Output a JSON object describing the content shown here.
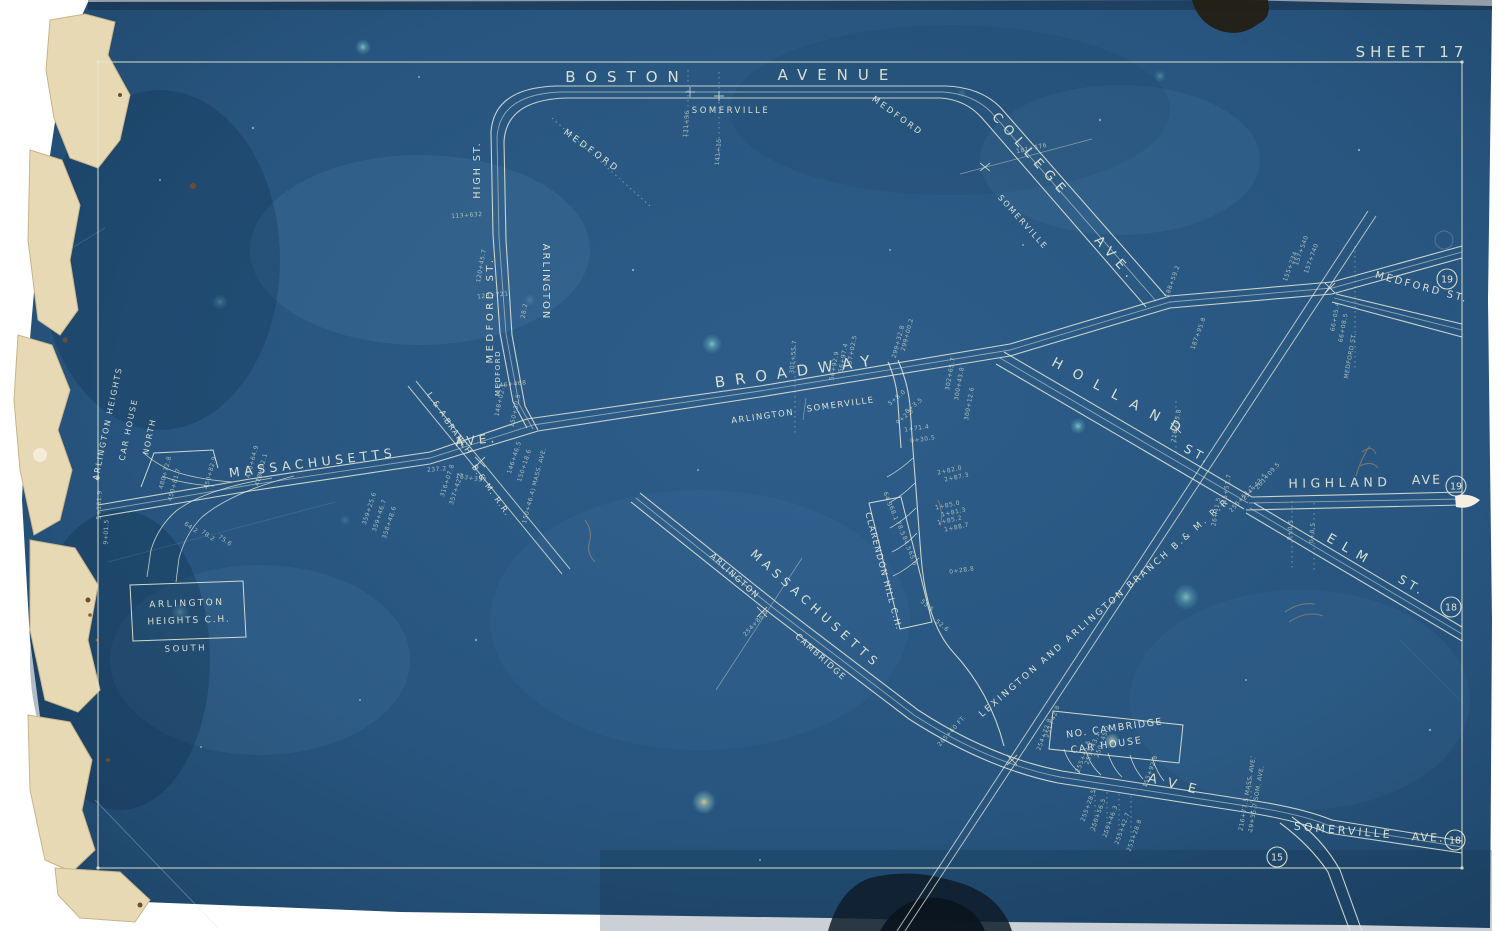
{
  "map": {
    "sheet_label": "SHEET 17",
    "colors": {
      "blueprint_blue": "#24527e",
      "blueprint_edge": "#1c4062",
      "line_pale": "#e6e8d6",
      "torn_paper_cream": "#e7d9b4",
      "pencil_sepia": "#b98e5e",
      "stain_dark": "#241d12"
    },
    "street_labels": [
      {
        "t": "BOSTON",
        "x": 627,
        "y": 82,
        "r": 0,
        "s": 15,
        "sp": 10
      },
      {
        "t": "AVENUE",
        "x": 838,
        "y": 80,
        "r": 0,
        "s": 15,
        "sp": 10
      },
      {
        "t": "SOMERVILLE",
        "x": 731,
        "y": 113,
        "r": 0,
        "s": 8.5,
        "sp": 2.5
      },
      {
        "t": "MEDFORD",
        "x": 896,
        "y": 118,
        "r": 36,
        "s": 8.5,
        "sp": 2.5
      },
      {
        "t": "MEDFORD",
        "x": 590,
        "y": 153,
        "r": 36,
        "s": 9,
        "sp": 3
      },
      {
        "t": "HIGH ST.",
        "x": 480,
        "y": 170,
        "r": -90,
        "s": 9.5,
        "sp": 2
      },
      {
        "t": "MEDFORD ST.",
        "x": 493,
        "y": 310,
        "r": -90,
        "s": 10,
        "sp": 3.5
      },
      {
        "t": "ARLINGTON",
        "x": 543,
        "y": 282,
        "r": 90,
        "s": 10,
        "sp": 2
      },
      {
        "t": "MEDFORD",
        "x": 500,
        "y": 373,
        "r": -90,
        "s": 7,
        "sp": 1.5
      },
      {
        "t": "COLLEGE",
        "x": 1028,
        "y": 158,
        "r": 48,
        "s": 13,
        "sp": 7
      },
      {
        "t": "AVE.",
        "x": 1113,
        "y": 262,
        "r": 48,
        "s": 13,
        "sp": 7
      },
      {
        "t": "SOMERVILLE",
        "x": 1021,
        "y": 224,
        "r": 48,
        "s": 8,
        "sp": 2
      },
      {
        "t": "BROADWAY",
        "x": 798,
        "y": 376,
        "r": -8,
        "s": 15,
        "sp": 10
      },
      {
        "t": "ARLINGTON",
        "x": 763,
        "y": 419,
        "r": -8,
        "s": 8.5,
        "sp": 1.5
      },
      {
        "t": "SOMERVILLE",
        "x": 841,
        "y": 407,
        "r": -8,
        "s": 8.5,
        "sp": 1.5
      },
      {
        "t": "MASSACHUSETTS",
        "x": 313,
        "y": 467,
        "r": -7,
        "s": 12.5,
        "sp": 4.5
      },
      {
        "t": "AVE.",
        "x": 477,
        "y": 444,
        "r": -6,
        "s": 12,
        "sp": 4
      },
      {
        "t": "L.& A.",
        "x": 436,
        "y": 408,
        "r": 55,
        "s": 8,
        "sp": 1.5
      },
      {
        "t": "BRANCH",
        "x": 456,
        "y": 438,
        "r": 55,
        "s": 8,
        "sp": 1.5
      },
      {
        "t": "B.& M. R.R.",
        "x": 489,
        "y": 492,
        "r": 55,
        "s": 8,
        "sp": 1.5
      },
      {
        "t": "HOLLAND",
        "x": 1120,
        "y": 402,
        "r": 28,
        "s": 13.5,
        "sp": 13
      },
      {
        "t": "ST.",
        "x": 1196,
        "y": 458,
        "r": 28,
        "s": 12,
        "sp": 4
      },
      {
        "t": "HIGHLAND",
        "x": 1340,
        "y": 487,
        "r": -1,
        "s": 12.5,
        "sp": 4.5
      },
      {
        "t": "AVE",
        "x": 1427,
        "y": 484,
        "r": -1,
        "s": 12.5,
        "sp": 2
      },
      {
        "t": "ELM",
        "x": 1349,
        "y": 554,
        "r": 30,
        "s": 13,
        "sp": 9
      },
      {
        "t": "ST.",
        "x": 1410,
        "y": 589,
        "r": 30,
        "s": 12,
        "sp": 4
      },
      {
        "t": "MEDFORD ST.",
        "x": 1421,
        "y": 290,
        "r": 15,
        "s": 10,
        "sp": 2.5
      },
      {
        "t": "LEXINGTON AND ARLINGTON BRANCH B.& M. R.R.",
        "x": 1108,
        "y": 608,
        "r": -41,
        "s": 9,
        "sp": 2.6
      },
      {
        "t": "MASSACHUSETTS",
        "x": 813,
        "y": 612,
        "r": 42,
        "s": 12,
        "sp": 5
      },
      {
        "t": "ARLINGTON",
        "x": 733,
        "y": 578,
        "r": 42,
        "s": 8.5,
        "sp": 1.5
      },
      {
        "t": "CAMBRIDGE",
        "x": 819,
        "y": 659,
        "r": 42,
        "s": 8.5,
        "sp": 1.5
      },
      {
        "t": "ARLINGTON HEIGHTS",
        "x": 110,
        "y": 424,
        "r": -78,
        "s": 8,
        "sp": 1.8
      },
      {
        "t": "CAR HOUSE",
        "x": 131,
        "y": 430,
        "r": -78,
        "s": 8,
        "sp": 1.8
      },
      {
        "t": "NORTH",
        "x": 152,
        "y": 437,
        "r": -78,
        "s": 8,
        "sp": 1.8
      },
      {
        "t": "ARLINGTON",
        "x": 187,
        "y": 606,
        "r": -2,
        "s": 9,
        "sp": 2.5
      },
      {
        "t": "HEIGHTS C.H.",
        "x": 189,
        "y": 623,
        "r": -2,
        "s": 9,
        "sp": 1.8
      },
      {
        "t": "SOUTH",
        "x": 186,
        "y": 651,
        "r": -2,
        "s": 8.5,
        "sp": 2.5
      },
      {
        "t": "CLARENDON HILL C.H.",
        "x": 881,
        "y": 572,
        "r": 75,
        "s": 8.5,
        "sp": 1.4
      },
      {
        "t": "NO. CAMBRIDGE",
        "x": 1115,
        "y": 731,
        "r": -8,
        "s": 9.5,
        "sp": 1.5
      },
      {
        "t": "CAR HOUSE",
        "x": 1107,
        "y": 748,
        "r": -8,
        "s": 9.5,
        "sp": 1.8
      },
      {
        "t": "AVE",
        "x": 1177,
        "y": 789,
        "r": 14,
        "s": 13,
        "sp": 12
      },
      {
        "t": "SOMERVILLE",
        "x": 1343,
        "y": 834,
        "r": 5,
        "s": 11,
        "sp": 3
      },
      {
        "t": "AVE.",
        "x": 1428,
        "y": 841,
        "r": 3,
        "s": 11,
        "sp": 2
      }
    ],
    "station_marks": [
      {
        "t": "5+131.9",
        "x": 101,
        "y": 505,
        "r": -88
      },
      {
        "t": "9+01.5",
        "x": 108,
        "y": 532,
        "r": -88
      },
      {
        "t": "480+72.8",
        "x": 167,
        "y": 473,
        "r": -75
      },
      {
        "t": "450+81.7",
        "x": 176,
        "y": 485,
        "r": -75
      },
      {
        "t": "450+82.9",
        "x": 212,
        "y": 473,
        "r": -75
      },
      {
        "t": "410+64.9",
        "x": 254,
        "y": 462,
        "r": -75
      },
      {
        "t": "418+92.1",
        "x": 263,
        "y": 470,
        "r": -75
      },
      {
        "t": "64.2",
        "x": 190,
        "y": 529,
        "r": 35
      },
      {
        "t": "78.2",
        "x": 207,
        "y": 537,
        "r": 35
      },
      {
        "t": "75.6",
        "x": 224,
        "y": 542,
        "r": 35
      },
      {
        "t": "359+25.6",
        "x": 371,
        "y": 509,
        "r": -72
      },
      {
        "t": "359+46.7",
        "x": 381,
        "y": 516,
        "r": -72
      },
      {
        "t": "358+48.6",
        "x": 391,
        "y": 523,
        "r": -72
      },
      {
        "t": "237.2",
        "x": 437,
        "y": 471,
        "r": -5
      },
      {
        "t": "163+337",
        "x": 471,
        "y": 480,
        "r": 8
      },
      {
        "t": "316+07.8",
        "x": 449,
        "y": 481,
        "r": -72
      },
      {
        "t": "357+42.5",
        "x": 458,
        "y": 489,
        "r": -72
      },
      {
        "t": "146+46.5",
        "x": 516,
        "y": 458,
        "r": -72
      },
      {
        "t": "150+18.6",
        "x": 526,
        "y": 466,
        "r": -72
      },
      {
        "t": "150+46.4) MASS. AVE.",
        "x": 536,
        "y": 486,
        "r": -75
      },
      {
        "t": "113+632",
        "x": 467,
        "y": 217,
        "r": -4
      },
      {
        "t": "120+45.7",
        "x": 483,
        "y": 266,
        "r": -80
      },
      {
        "t": "123+721",
        "x": 493,
        "y": 297,
        "r": -6
      },
      {
        "t": "28.2",
        "x": 526,
        "y": 311,
        "r": -80
      },
      {
        "t": "146+468",
        "x": 511,
        "y": 386,
        "r": -6
      },
      {
        "t": "148+02.1",
        "x": 502,
        "y": 400,
        "r": -78
      },
      {
        "t": "150+30.5",
        "x": 517,
        "y": 411,
        "r": -78
      },
      {
        "t": "131+96",
        "x": 688,
        "y": 124,
        "r": -85
      },
      {
        "t": "141+15",
        "x": 720,
        "y": 152,
        "r": -85
      },
      {
        "t": "181+176",
        "x": 1032,
        "y": 150,
        "r": -12
      },
      {
        "t": "301+55.7",
        "x": 795,
        "y": 357,
        "r": -85
      },
      {
        "t": "56+92.9",
        "x": 836,
        "y": 366,
        "r": -80
      },
      {
        "t": "56+97.4",
        "x": 845,
        "y": 358,
        "r": -80
      },
      {
        "t": "57+02.5",
        "x": 854,
        "y": 350,
        "r": -80
      },
      {
        "t": "299+32.8",
        "x": 900,
        "y": 342,
        "r": -75
      },
      {
        "t": "299+00.2",
        "x": 909,
        "y": 335,
        "r": -75
      },
      {
        "t": "302+65.7",
        "x": 952,
        "y": 374,
        "r": -80
      },
      {
        "t": "300+43.8",
        "x": 961,
        "y": 384,
        "r": -80
      },
      {
        "t": "300+12.6",
        "x": 971,
        "y": 404,
        "r": -80
      },
      {
        "t": "5+8.0",
        "x": 898,
        "y": 399,
        "r": -40
      },
      {
        "t": "8+3.5",
        "x": 915,
        "y": 407,
        "r": -40
      },
      {
        "t": "9+2.5",
        "x": 906,
        "y": 418,
        "r": -40
      },
      {
        "t": "1+71.4",
        "x": 917,
        "y": 430,
        "r": -8
      },
      {
        "t": "0+30.5",
        "x": 923,
        "y": 441,
        "r": -8
      },
      {
        "t": "2+82.0",
        "x": 950,
        "y": 472,
        "r": -12
      },
      {
        "t": "2+87.3",
        "x": 957,
        "y": 479,
        "r": -12
      },
      {
        "t": "1+85.0",
        "x": 948,
        "y": 507,
        "r": -12
      },
      {
        "t": "1+81.3",
        "x": 954,
        "y": 514,
        "r": -12
      },
      {
        "t": "1+85.2",
        "x": 950,
        "y": 522,
        "r": -12
      },
      {
        "t": "1+88.7",
        "x": 957,
        "y": 529,
        "r": -12
      },
      {
        "t": "0+28.8",
        "x": 962,
        "y": 572,
        "r": -8
      },
      {
        "t": "64.3",
        "x": 886,
        "y": 500,
        "r": 70
      },
      {
        "t": "68.1",
        "x": 892,
        "y": 514,
        "r": 70
      },
      {
        "t": "78.5",
        "x": 899,
        "y": 529,
        "r": 70
      },
      {
        "t": "84.5",
        "x": 905,
        "y": 544,
        "r": 70
      },
      {
        "t": "65.6",
        "x": 911,
        "y": 559,
        "r": 70
      },
      {
        "t": "55.5",
        "x": 926,
        "y": 607,
        "r": 40
      },
      {
        "t": "52.6",
        "x": 941,
        "y": 627,
        "r": 40
      },
      {
        "t": "216+05.8",
        "x": 1178,
        "y": 426,
        "r": -80
      },
      {
        "t": "215+51.7",
        "x": 1228,
        "y": 491,
        "r": -80
      },
      {
        "t": "26+41.5",
        "x": 1218,
        "y": 512,
        "r": -80
      },
      {
        "t": "255+51.7",
        "x": 1243,
        "y": 500,
        "r": -48
      },
      {
        "t": "254+43.5",
        "x": 1256,
        "y": 488,
        "r": -48
      },
      {
        "t": "261+09.5",
        "x": 1269,
        "y": 477,
        "r": -48
      },
      {
        "t": "188+59.2",
        "x": 1174,
        "y": 282,
        "r": -70
      },
      {
        "t": "187+95.8",
        "x": 1200,
        "y": 334,
        "r": -70
      },
      {
        "t": "155+234",
        "x": 1292,
        "y": 267,
        "r": -70
      },
      {
        "t": "157+540",
        "x": 1303,
        "y": 251,
        "r": -70
      },
      {
        "t": "157+740",
        "x": 1313,
        "y": 259,
        "r": -70
      },
      {
        "t": "66+05.4",
        "x": 1337,
        "y": 317,
        "r": -80
      },
      {
        "t": "66+08.5",
        "x": 1345,
        "y": 328,
        "r": -80
      },
      {
        "t": "MEDFORD ST.",
        "x": 1352,
        "y": 356,
        "r": -80
      },
      {
        "t": "0+0.5",
        "x": 1292,
        "y": 530,
        "r": -85
      },
      {
        "t": "0+8.5",
        "x": 1314,
        "y": 533,
        "r": -85
      },
      {
        "t": "265+60 FT.",
        "x": 953,
        "y": 732,
        "r": -48
      },
      {
        "t": "254+86.5",
        "x": 757,
        "y": 624,
        "r": -48
      },
      {
        "t": "216+77.5 MASS. AVE.",
        "x": 1249,
        "y": 794,
        "r": -80
      },
      {
        "t": "19+35.7 SOM. AVE.",
        "x": 1258,
        "y": 799,
        "r": -80
      },
      {
        "t": "254+72.8",
        "x": 1046,
        "y": 735,
        "r": -70
      },
      {
        "t": "251+42.8",
        "x": 1054,
        "y": 722,
        "r": -70
      },
      {
        "t": "255+45.5",
        "x": 1085,
        "y": 757,
        "r": -70
      },
      {
        "t": "259+43.1",
        "x": 1094,
        "y": 749,
        "r": -70
      },
      {
        "t": "250+45.2",
        "x": 1104,
        "y": 742,
        "r": -70
      },
      {
        "t": "255+28.5",
        "x": 1090,
        "y": 806,
        "r": -70
      },
      {
        "t": "250+56.5",
        "x": 1100,
        "y": 815,
        "r": -70
      },
      {
        "t": "259+46.3",
        "x": 1112,
        "y": 822,
        "r": -70
      },
      {
        "t": "255+42.7",
        "x": 1124,
        "y": 829,
        "r": -70
      },
      {
        "t": "253+28.8",
        "x": 1136,
        "y": 836,
        "r": -70
      },
      {
        "t": "155+92.8",
        "x": 1152,
        "y": 772,
        "r": -70
      }
    ],
    "sheet_refs": [
      {
        "t": "19",
        "x": 1447,
        "y": 279
      },
      {
        "t": "19",
        "x": 1456,
        "y": 486
      },
      {
        "t": "18",
        "x": 1451,
        "y": 607
      },
      {
        "t": "18",
        "x": 1455,
        "y": 840
      },
      {
        "t": "15",
        "x": 1277,
        "y": 857
      }
    ]
  }
}
